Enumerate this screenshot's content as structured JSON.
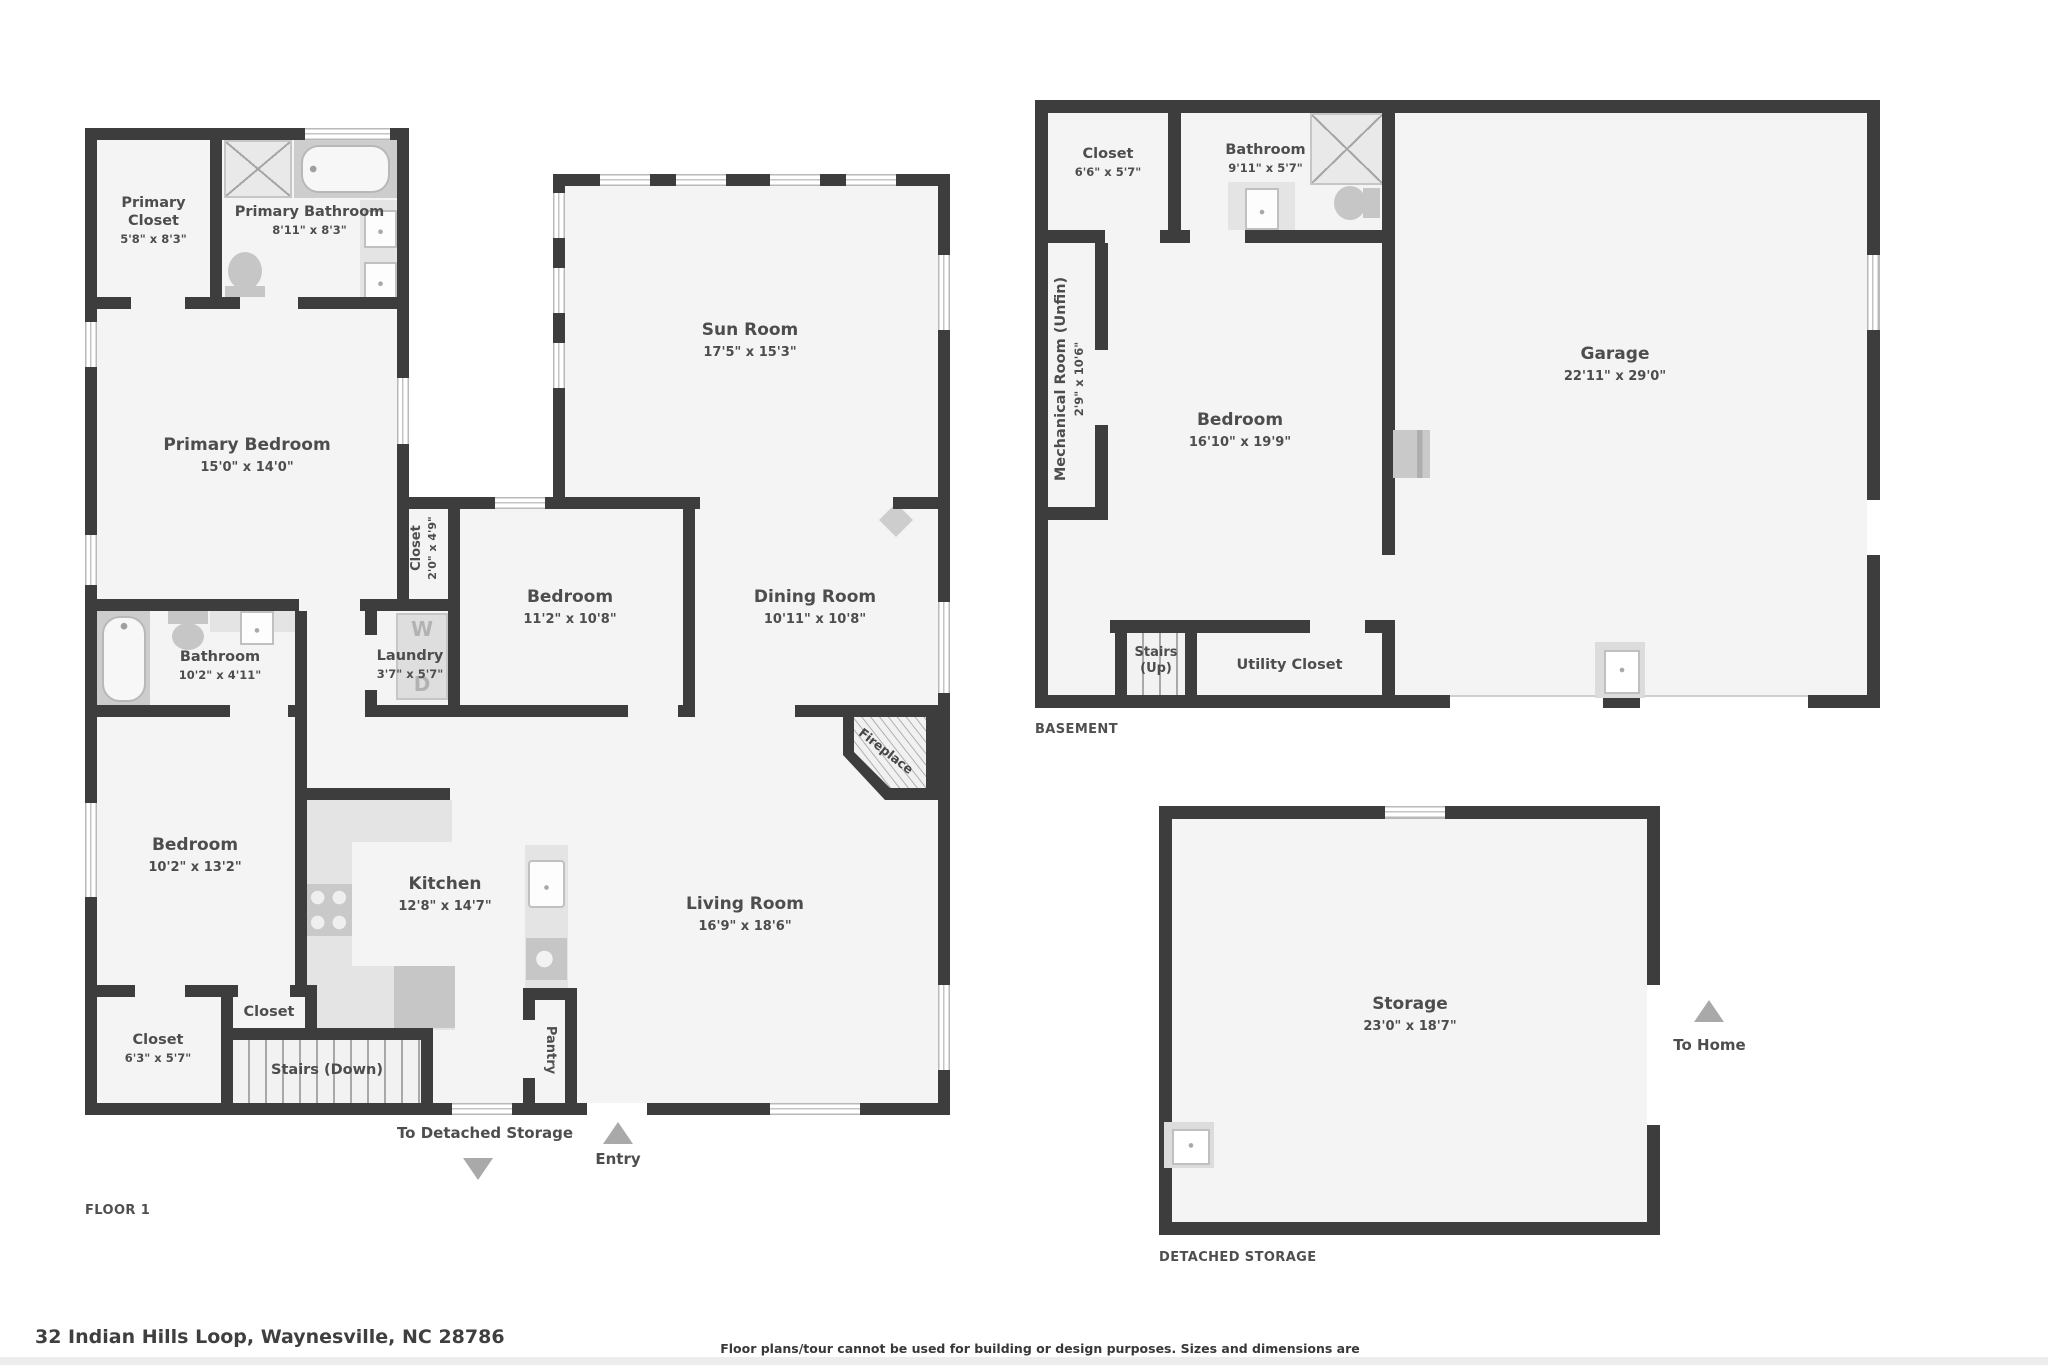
{
  "floor1": {
    "plan_label": "FLOOR 1",
    "rooms": {
      "primary_closet": {
        "name": "Primary Closet",
        "dims": "5'8\" x 8'3\""
      },
      "primary_bathroom": {
        "name": "Primary Bathroom",
        "dims": "8'11\" x 8'3\""
      },
      "primary_bedroom": {
        "name": "Primary Bedroom",
        "dims": "15'0\" x 14'0\""
      },
      "sun_room": {
        "name": "Sun Room",
        "dims": "17'5\" x 15'3\""
      },
      "hall_closet": {
        "name": "Closet",
        "dims": "2'0\" x 4'9\""
      },
      "bedroom_middle": {
        "name": "Bedroom",
        "dims": "11'2\" x 10'8\""
      },
      "dining_room": {
        "name": "Dining Room",
        "dims": "10'11\" x 10'8\""
      },
      "bathroom": {
        "name": "Bathroom",
        "dims": "10'2\" x 4'11\""
      },
      "laundry": {
        "name": "Laundry",
        "dims": "3'7\" x 5'7\""
      },
      "bedroom_left": {
        "name": "Bedroom",
        "dims": "10'2\" x 13'2\""
      },
      "kitchen": {
        "name": "Kitchen",
        "dims": "12'8\" x 14'7\""
      },
      "living_room": {
        "name": "Living Room",
        "dims": "16'9\" x 18'6\""
      },
      "small_closet": {
        "name": "Closet"
      },
      "corner_closet": {
        "name": "Closet",
        "dims": "6'3\" x 5'7\""
      },
      "stairs_down": {
        "name": "Stairs (Down)"
      },
      "pantry": {
        "name": "Pantry"
      },
      "fireplace": {
        "name": "Fireplace"
      }
    },
    "appliances": {
      "washer": "W",
      "dryer": "D"
    },
    "annotations": {
      "to_detached_storage": "To Detached Storage",
      "entry": "Entry"
    }
  },
  "basement": {
    "plan_label": "BASEMENT",
    "rooms": {
      "closet": {
        "name": "Closet",
        "dims": "6'6\" x 5'7\""
      },
      "bathroom": {
        "name": "Bathroom",
        "dims": "9'11\" x 5'7\""
      },
      "mechanical_room": {
        "name": "Mechanical Room (Unfin)",
        "dims": "2'9\" x 10'6\""
      },
      "bedroom": {
        "name": "Bedroom",
        "dims": "16'10\" x 19'9\""
      },
      "garage": {
        "name": "Garage",
        "dims": "22'11\" x 29'0\""
      },
      "stairs_up": {
        "name": "Stairs (Up)"
      },
      "utility_closet": {
        "name": "Utility Closet"
      }
    }
  },
  "detached_storage": {
    "plan_label": "DETACHED STORAGE",
    "rooms": {
      "storage": {
        "name": "Storage",
        "dims": "23'0\" x 18'7\""
      }
    },
    "annotations": {
      "to_home": "To Home"
    }
  },
  "footer": {
    "address": "32 Indian Hills Loop, Waynesville, NC 28786",
    "disclaimer": "Floor plans/tour cannot be used for building or design purposes. Sizes and dimensions are approximate."
  },
  "colors": {
    "wall": "#3d3d3d",
    "floor": "#f4f4f4",
    "fixture": "#d6d6d6",
    "text": "#4d4d4d",
    "arrow": "#a9a9a9"
  }
}
